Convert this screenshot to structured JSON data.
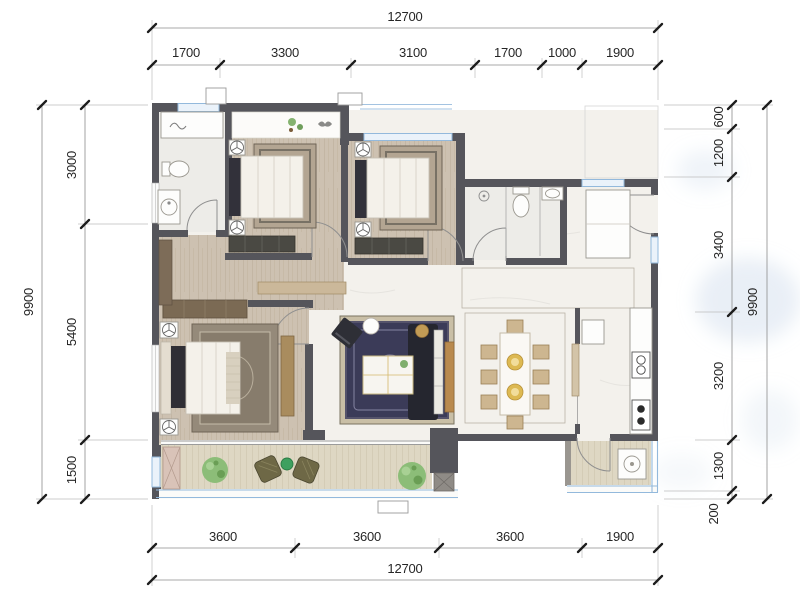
{
  "page": {
    "type": "architectural-floor-plan"
  },
  "dims": {
    "top": {
      "total": "12700",
      "segs": [
        "1700",
        "3300",
        "3100",
        "1700",
        "1000",
        "1900"
      ]
    },
    "bottom": {
      "total": "12700",
      "segs": [
        "3600",
        "3600",
        "3600",
        "1900"
      ]
    },
    "left": {
      "total": "9900",
      "segs": [
        "3000",
        "5400",
        "1500"
      ]
    },
    "right": {
      "total": "9900",
      "segs": [
        "600",
        "1200",
        "3400",
        "3200",
        "1300",
        "200"
      ]
    }
  },
  "rooms": [
    {
      "name": "bedroom-1"
    },
    {
      "name": "bedroom-2"
    },
    {
      "name": "master-bedroom"
    },
    {
      "name": "living-room"
    },
    {
      "name": "dining-room"
    },
    {
      "name": "kitchen"
    },
    {
      "name": "bathroom-ensuite"
    },
    {
      "name": "bathroom-shared"
    },
    {
      "name": "entry-foyer"
    },
    {
      "name": "balcony"
    },
    {
      "name": "service-balcony"
    }
  ],
  "colors": {
    "wall": "#55555b",
    "window": "#93b9dc",
    "wood_floor": "#cdc1b1",
    "marble_floor": "#f3f1ec",
    "bath_floor": "#edece8",
    "deck": "#ded7c3",
    "rug_navy": "#3b3b58",
    "rug_border": "#c9bfa6",
    "wood_accent": "#b98a4e",
    "sofa": "#25262f",
    "plant": "#8cbd78",
    "dim_text": "#262626"
  }
}
